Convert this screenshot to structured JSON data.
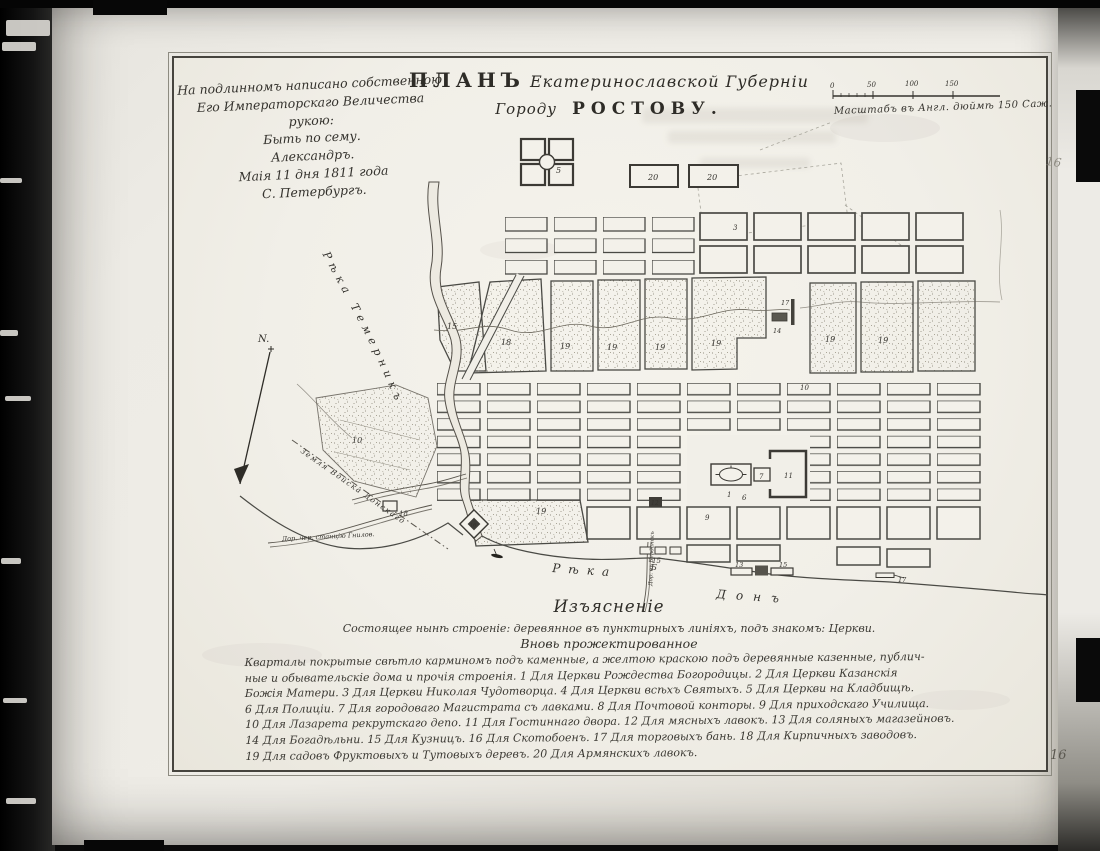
{
  "colors": {
    "paper": "#f2f0e9",
    "ink": "#3a3835",
    "plate_border": "#46443e"
  },
  "page": {
    "number_top": "16",
    "number_bottom": "16"
  },
  "inscription": {
    "lines": [
      "На подлинномъ написано собственною",
      "Его Императорскаго Величества рукою:",
      "Быть по сему.",
      "Александръ.",
      "Маія 11 дня 1811 года",
      "С. Петербургъ."
    ]
  },
  "title": {
    "word_plan": "ПЛАНЪ",
    "script_province": "Екатеринославской Губерніи",
    "word_city": "Городу",
    "word_rostov": "РОСТОВУ."
  },
  "scale": {
    "ticks": [
      "0",
      "50",
      "100",
      "150"
    ],
    "caption": "Масштабъ въ Англ. дюймѣ 150 Саж."
  },
  "compass": {
    "north_label": "N."
  },
  "map": {
    "rivers": {
      "temernik": "Рѣка Темерникъ",
      "don_word1": "Рѣка",
      "don_word2": "Донъ"
    },
    "roads": {
      "gnilovskaya": "Дор. чер. станцію Гнилов.",
      "boundary": "Земля Войска Донскаго",
      "south_road": "Дор. въ Берданскъ"
    },
    "numbers": {
      "one": "1",
      "three": "3",
      "five": "5",
      "six": "6",
      "seven": "7",
      "nine": "9",
      "ten": "10",
      "eleven": "11",
      "twelve": "12",
      "thirteen": "13",
      "fourteen": "14",
      "fifteen": "15",
      "sixteen": "16",
      "seventeen": "17",
      "eighteen": "18",
      "nineteen": "19",
      "twenty": "20",
      "letter_b": "Б"
    }
  },
  "legend": {
    "heading": "Изъясненіе",
    "existing_note": "Состоящее нынѣ строеніе: деревянное въ пунктирныхъ линіяхъ, подъ знакомъ: Церкви.",
    "subheading": "Вновь прожектированное",
    "body": [
      "Кварталы покрытые свѣтло карминомъ подъ каменные, а желтою краскою подъ деревянные казенные, публич-",
      "ные и обывательскіе дома и прочія строенія. 1 Для Церкви Рождества Богородицы. 2 Для Церкви Казанскія",
      "Божія Матери. 3 Для Церкви Николая Чудотворца. 4 Для Церкви всѣхъ Святыхъ. 5 Для Церкви на Кладбищѣ.",
      "6 Для Полиціи. 7 Для городоваго Магистрата съ лавками. 8 Для Почтовой конторы. 9 Для приходскаго Училища.",
      "10 Для Лазарета рекрутскаго депо. 11 Для Гостиннаго двора. 12 Для мясныхъ лавокъ. 13 Для соляныхъ магазейновъ.",
      "14 Для Богадѣльни. 15 Для Кузницъ. 16 Для Скотобоенъ. 17 Для торговыхъ бань. 18 Для Кирпичныхъ заводовъ.",
      "19 Для садовъ Фруктовыхъ и Тутовыхъ деревъ. 20 Для Армянскихъ лавокъ."
    ]
  }
}
